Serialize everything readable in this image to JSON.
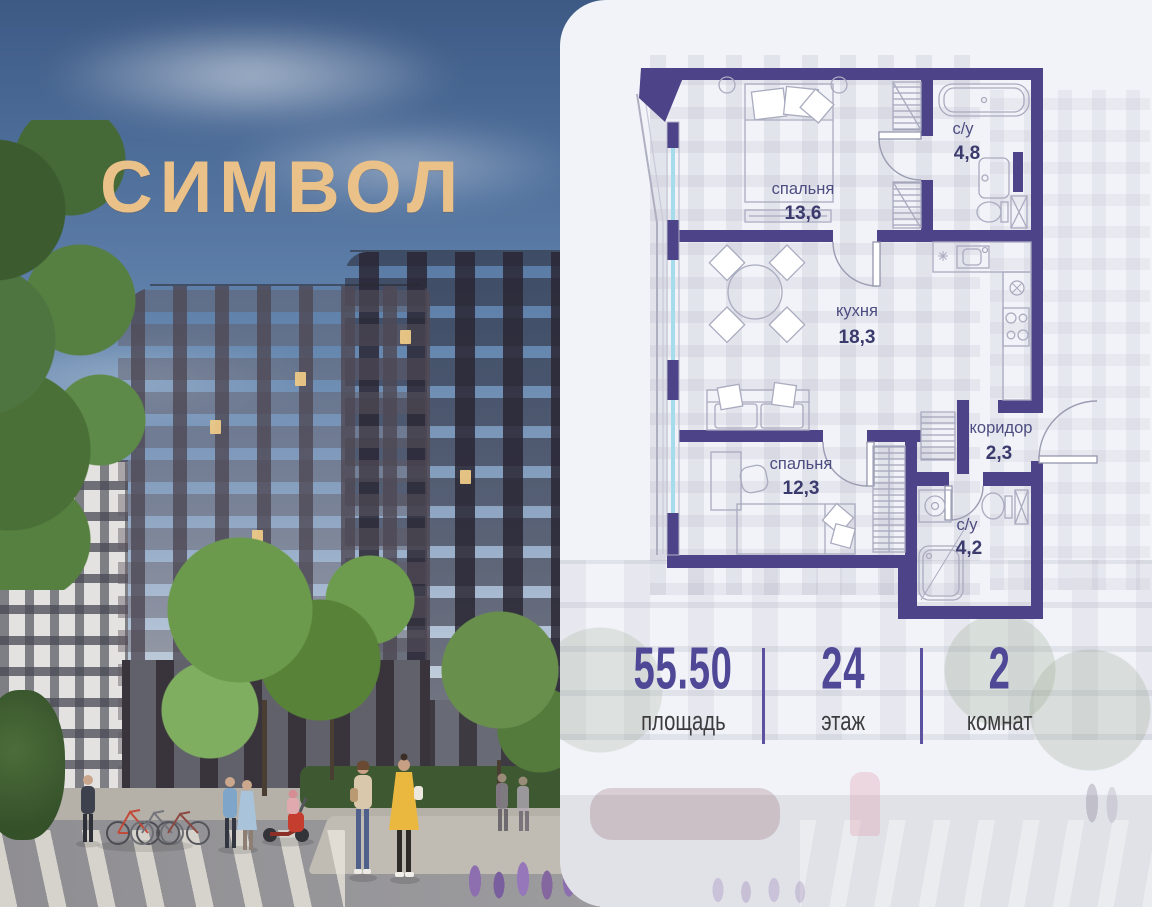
{
  "brand": {
    "logo_text": "СИМВОЛ",
    "logo_color": "#e9c189"
  },
  "floor_plan": {
    "wall_color": "#4d4389",
    "label_color": "#4c4c80",
    "window_glass_color": "#a6dbec",
    "rooms": [
      {
        "name": "спальня",
        "area": "13,6"
      },
      {
        "name": "с/у",
        "area": "4,8"
      },
      {
        "name": "кухня",
        "area": "18,3"
      },
      {
        "name": "коридор",
        "area": "2,3"
      },
      {
        "name": "спальня",
        "area": "12,3"
      },
      {
        "name": "с/у",
        "area": "4,2"
      }
    ]
  },
  "stats": {
    "value_color": "#4e4896",
    "items": [
      {
        "value": "55.50",
        "label": "площадь"
      },
      {
        "value": "24",
        "label": "этаж"
      },
      {
        "value": "2",
        "label": "комнат"
      }
    ]
  }
}
